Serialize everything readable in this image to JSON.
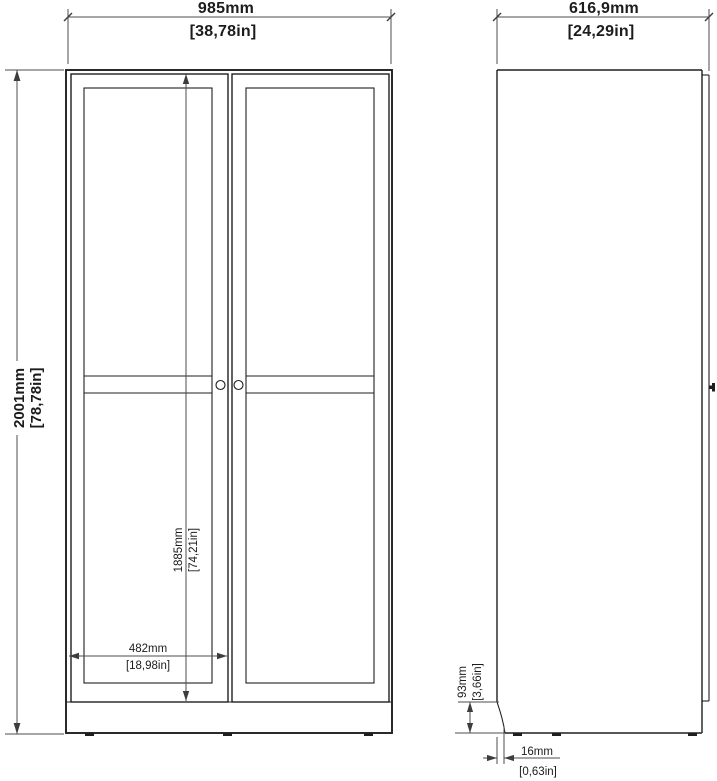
{
  "drawing": {
    "type": "furniture-dimension-diagram",
    "subject": "two-door wardrobe, front and side elevation views"
  },
  "dims": {
    "front_width": {
      "mm": "985mm",
      "in": "[38,78in]"
    },
    "front_height": {
      "mm": "2001mm",
      "in": "[78,78in]"
    },
    "door_height": {
      "mm": "1885mm",
      "in": "[74,21in]"
    },
    "door_width": {
      "mm": "482mm",
      "in": "[18,98in]"
    },
    "side_depth": {
      "mm": "616,9mm",
      "in": "[24,29in]"
    },
    "plinth_height": {
      "mm": "93mm",
      "in": "[3,66in]"
    },
    "base_thickness": {
      "mm": "16mm",
      "in": "[0,63in]"
    }
  },
  "colors": {
    "background": "#ffffff",
    "object_line": "#1f1f1f",
    "dimension_line": "#4d4d4d",
    "text": "#1c1c1c"
  }
}
